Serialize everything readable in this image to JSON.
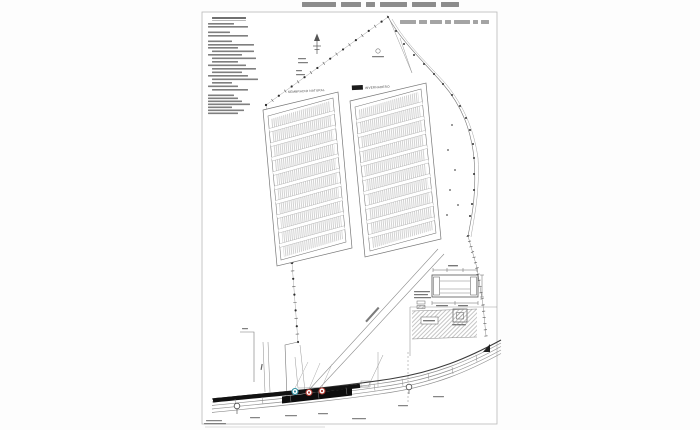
{
  "page": {
    "background": "#fdfdfd",
    "sheet_border": "#b8b8b8",
    "ink": "#4a4a4a"
  },
  "labels": {
    "field_left": "SEMBRADIO NATURAL",
    "field_right": "INVERNADERO"
  },
  "fields": {
    "left_rows": 10,
    "right_rows": 10
  },
  "markers": [
    {
      "name": "service-marker-blue",
      "color": "#2f8fa0"
    },
    {
      "name": "service-marker-red-1",
      "color": "#b23a31"
    },
    {
      "name": "service-marker-red-2",
      "color": "#b23a31"
    }
  ],
  "colors": {
    "road_surface": "#121212",
    "road_lines": "#8f8f8f",
    "field_hatch": "#9b9b9b",
    "area_hatch": "#8c8c8c",
    "tree_dots": "#2f2f2f",
    "text_bars": "#5f5f5f",
    "thin_line": "#8a8a8a"
  }
}
